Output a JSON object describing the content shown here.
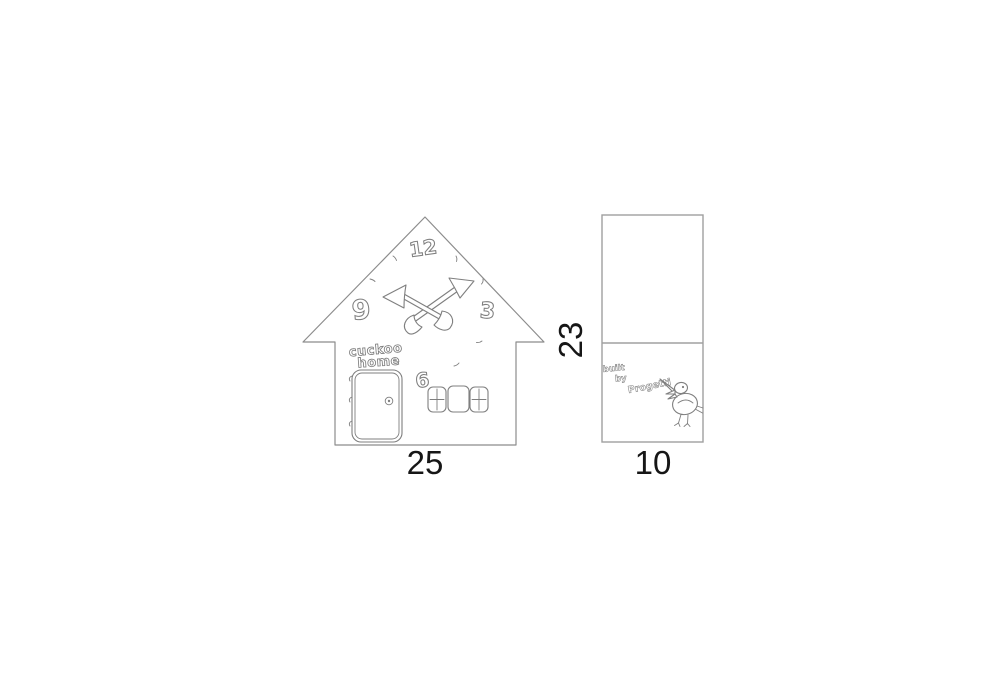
{
  "front_view": {
    "clock_numerals": {
      "n12": "12",
      "n3": "3",
      "n6": "6",
      "n9": "9"
    },
    "sign": {
      "line1": "cuckoo",
      "line2": "home"
    },
    "width_label": "25"
  },
  "side_view": {
    "height_label": "23",
    "width_label": "10",
    "credit": {
      "line1": "built",
      "line2": "by",
      "line3": "Progetti"
    }
  },
  "colors": {
    "front_outline": "#8c8c8c",
    "side_outline": "#a0a0a0",
    "sketch": "#7f7f7f",
    "dimension_text": "#161616",
    "paper": "#ffffff"
  }
}
